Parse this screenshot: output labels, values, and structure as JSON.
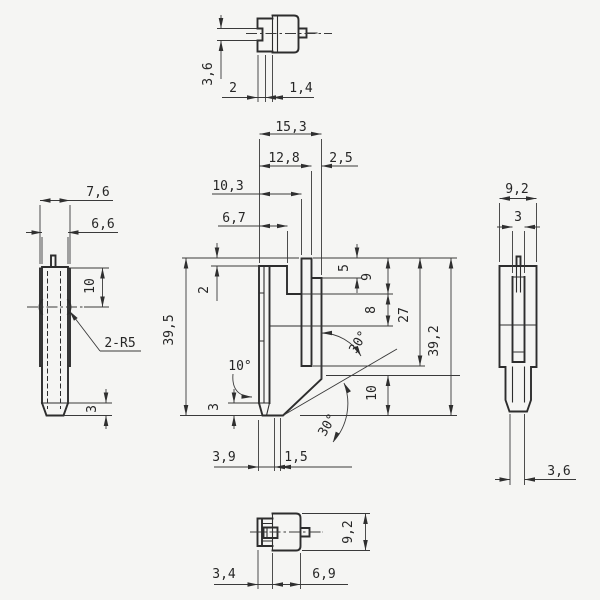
{
  "colors": {
    "background": "#f5f5f3",
    "part_line": "#2d2d2d",
    "dimension_line": "#3a3a3a",
    "text": "#262626"
  },
  "views": {
    "top": {
      "name": "top-view",
      "dims": {
        "waist_height": "3,6",
        "flange_width": "2",
        "waist_width": "1,4"
      }
    },
    "front": {
      "name": "front-view",
      "dims": {
        "overall_width": "15,3",
        "arm_width": "12,8",
        "wall_thickness": "2,5",
        "inner_width": "10,3",
        "plate_width": "6,7",
        "top_step": "2",
        "height_left": "39,5",
        "gap_top": "5",
        "depth_upper": "9",
        "depth_lower": "8",
        "arm_length": "27",
        "height_right": "39,2",
        "bevel_height": "10",
        "tip_angle": "10°",
        "angle_upper": "30°",
        "angle_lower": "30°",
        "tip_height": "3",
        "tip_offset": "3,9",
        "land_width": "1,5"
      }
    },
    "left": {
      "name": "left-side-view",
      "dims": {
        "flange_depth": "7,6",
        "body_depth": "6,6",
        "groove_position": "10",
        "radius_note": "2-R5",
        "tip_height": "3"
      }
    },
    "right": {
      "name": "right-side-view",
      "dims": {
        "body_depth": "9,2",
        "slot_width": "3",
        "tip_depth": "3,6"
      }
    },
    "bottom": {
      "name": "bottom-view",
      "dims": {
        "body_depth": "9,2",
        "bracket_width": "3,4",
        "body_width": "6,9"
      }
    }
  }
}
